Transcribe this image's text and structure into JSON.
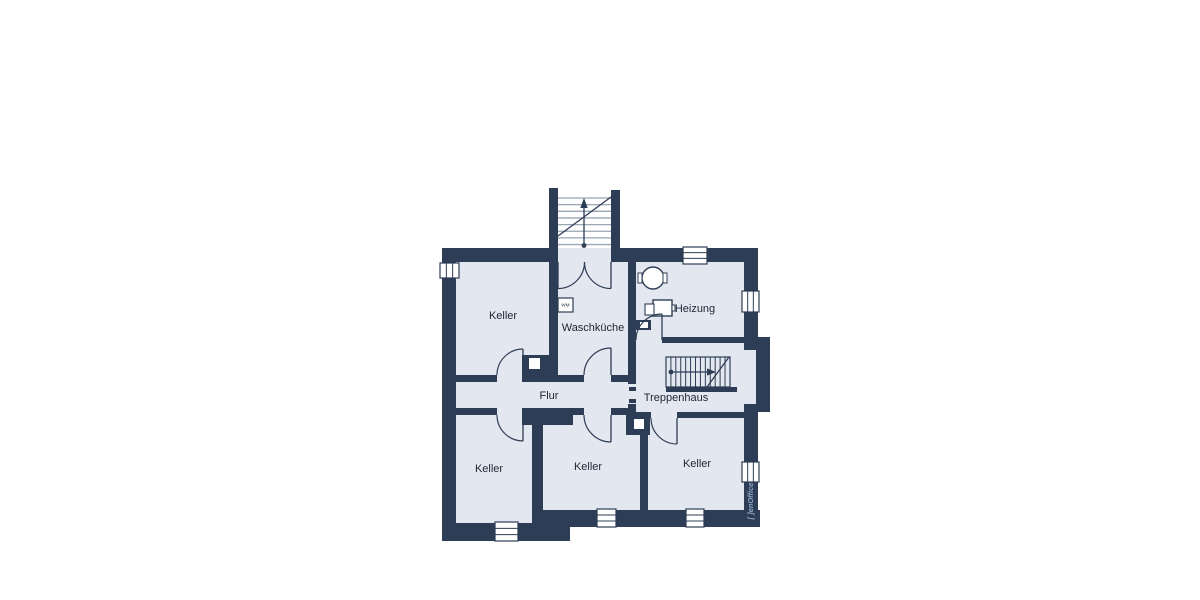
{
  "canvas": {
    "width": 1200,
    "height": 600
  },
  "colors": {
    "wall": "#2d3d55",
    "floor": "#e3e8f0",
    "white": "#ffffff",
    "tread": "#9aa5b5",
    "text": "#1c2636",
    "logo": "#8ca6c6"
  },
  "rooms": [
    {
      "id": "keller-upper-left",
      "label": "Keller"
    },
    {
      "id": "waschkueche",
      "label": "Waschküche"
    },
    {
      "id": "heizung",
      "label": "Heizung"
    },
    {
      "id": "flur",
      "label": "Flur"
    },
    {
      "id": "treppenhaus",
      "label": "Treppenhaus"
    },
    {
      "id": "keller-lower-left",
      "label": "Keller"
    },
    {
      "id": "keller-lower-middle",
      "label": "Keller"
    },
    {
      "id": "keller-lower-right",
      "label": "Keller"
    }
  ],
  "appliances": [
    {
      "id": "washing-machine",
      "label": "WM"
    }
  ],
  "branding": {
    "logo_text": "[ ]enOffice"
  },
  "floorplan": {
    "shapes": [
      {
        "type": "rect",
        "name": "floor-keller-upper-left",
        "x": 456,
        "y": 262,
        "w": 93,
        "h": 113,
        "fill": "floor"
      },
      {
        "type": "rect",
        "name": "floor-waschkueche",
        "x": 558,
        "y": 262,
        "w": 70,
        "h": 113,
        "fill": "floor"
      },
      {
        "type": "rect",
        "name": "floor-stair-landing",
        "x": 558,
        "y": 248,
        "w": 53,
        "h": 14,
        "fill": "floor"
      },
      {
        "type": "rect",
        "name": "floor-heizung",
        "x": 636,
        "y": 262,
        "w": 108,
        "h": 81,
        "fill": "floor"
      },
      {
        "type": "rect",
        "name": "floor-treppenhaus",
        "x": 636,
        "y": 343,
        "w": 108,
        "h": 69,
        "fill": "floor"
      },
      {
        "type": "rect",
        "name": "floor-flur",
        "x": 456,
        "y": 382,
        "w": 172,
        "h": 26,
        "fill": "floor"
      },
      {
        "type": "rect",
        "name": "floor-threshold",
        "x": 628,
        "y": 384,
        "w": 8,
        "h": 20,
        "fill": "floor"
      },
      {
        "type": "rect",
        "name": "floor-keller-lower-left",
        "x": 456,
        "y": 415,
        "w": 76,
        "h": 108,
        "fill": "floor"
      },
      {
        "type": "rect",
        "name": "floor-keller-lower-middle",
        "x": 543,
        "y": 415,
        "w": 97,
        "h": 95,
        "fill": "floor"
      },
      {
        "type": "rect",
        "name": "floor-keller-lower-right",
        "x": 648,
        "y": 418,
        "w": 96,
        "h": 92,
        "fill": "floor"
      },
      {
        "type": "rect",
        "name": "floor-door-opening",
        "x": 497,
        "y": 375,
        "w": 26,
        "h": 7,
        "fill": "floor"
      },
      {
        "type": "rect",
        "name": "floor-door-opening",
        "x": 584,
        "y": 375,
        "w": 27,
        "h": 7,
        "fill": "floor"
      },
      {
        "type": "rect",
        "name": "floor-door-opening",
        "x": 497,
        "y": 408,
        "w": 26,
        "h": 7,
        "fill": "floor"
      },
      {
        "type": "rect",
        "name": "floor-door-opening",
        "x": 584,
        "y": 408,
        "w": 27,
        "h": 7,
        "fill": "floor"
      },
      {
        "type": "rect",
        "name": "floor-door-opening",
        "x": 651,
        "y": 412,
        "w": 26,
        "h": 6,
        "fill": "floor"
      },
      {
        "type": "rect",
        "name": "wall-exterior-top-left",
        "x": 442,
        "y": 248,
        "w": 116,
        "h": 14,
        "fill": "wall"
      },
      {
        "type": "rect",
        "name": "wall-exterior-top-right",
        "x": 611,
        "y": 248,
        "w": 147,
        "h": 14,
        "fill": "wall"
      },
      {
        "type": "rect",
        "name": "wall-exterior-left",
        "x": 442,
        "y": 248,
        "w": 14,
        "h": 293,
        "fill": "wall"
      },
      {
        "type": "rect",
        "name": "wall-exterior-bottom-left",
        "x": 442,
        "y": 523,
        "w": 101,
        "h": 18,
        "fill": "wall"
      },
      {
        "type": "rect",
        "name": "wall-exterior-bottom-step",
        "x": 543,
        "y": 510,
        "w": 27,
        "h": 31,
        "fill": "wall"
      },
      {
        "type": "rect",
        "name": "wall-exterior-bottom-right",
        "x": 570,
        "y": 510,
        "w": 190,
        "h": 17,
        "fill": "wall"
      },
      {
        "type": "rect",
        "name": "wall-exterior-right",
        "x": 744,
        "y": 248,
        "w": 14,
        "h": 262,
        "fill": "wall"
      },
      {
        "type": "rect",
        "name": "wall-stairwell-bump",
        "x": 744,
        "y": 337,
        "w": 26,
        "h": 75,
        "fill": "wall"
      },
      {
        "type": "rect",
        "name": "wall-exterior-stair-left",
        "x": 549,
        "y": 188,
        "w": 9,
        "h": 194,
        "fill": "wall"
      },
      {
        "type": "rect",
        "name": "wall-exterior-stair-right",
        "x": 611,
        "y": 190,
        "w": 9,
        "h": 72,
        "fill": "wall"
      },
      {
        "type": "rect",
        "name": "wall-wasch-heizung",
        "x": 628,
        "y": 262,
        "w": 8,
        "h": 122,
        "fill": "wall"
      },
      {
        "type": "rect",
        "name": "wall-below-threshold",
        "x": 628,
        "y": 404,
        "w": 8,
        "h": 8,
        "fill": "wall"
      },
      {
        "type": "rect",
        "name": "wall-flur-top-a",
        "x": 456,
        "y": 375,
        "w": 41,
        "h": 7,
        "fill": "wall"
      },
      {
        "type": "rect",
        "name": "chimney-block",
        "x": 522,
        "y": 355,
        "w": 36,
        "h": 27,
        "fill": "wall"
      },
      {
        "type": "rect",
        "name": "wall-flur-top-b",
        "x": 555,
        "y": 375,
        "w": 29,
        "h": 7,
        "fill": "wall"
      },
      {
        "type": "rect",
        "name": "wall-flur-top-c",
        "x": 611,
        "y": 375,
        "w": 17,
        "h": 7,
        "fill": "wall"
      },
      {
        "type": "rect",
        "name": "wall-flur-bottom-a",
        "x": 456,
        "y": 408,
        "w": 41,
        "h": 7,
        "fill": "wall"
      },
      {
        "type": "rect",
        "name": "wall-flur-bottom-block",
        "x": 522,
        "y": 408,
        "w": 51,
        "h": 17,
        "fill": "wall"
      },
      {
        "type": "rect",
        "name": "wall-flur-bottom-b",
        "x": 573,
        "y": 408,
        "w": 11,
        "h": 7,
        "fill": "wall"
      },
      {
        "type": "rect",
        "name": "wall-flur-bottom-c",
        "x": 611,
        "y": 408,
        "w": 17,
        "h": 7,
        "fill": "wall"
      },
      {
        "type": "rect",
        "name": "wall-keller-divider-left",
        "x": 532,
        "y": 415,
        "w": 11,
        "h": 108,
        "fill": "wall"
      },
      {
        "type": "rect",
        "name": "wall-keller-divider-right",
        "x": 640,
        "y": 418,
        "w": 8,
        "h": 92,
        "fill": "wall"
      },
      {
        "type": "rect",
        "name": "wall-heizung-bottom",
        "x": 662,
        "y": 337,
        "w": 82,
        "h": 6,
        "fill": "wall"
      },
      {
        "type": "rect",
        "name": "wall-trepp-bottom-a",
        "x": 628,
        "y": 412,
        "w": 23,
        "h": 6,
        "fill": "wall"
      },
      {
        "type": "rect",
        "name": "wall-trepp-bottom-b",
        "x": 677,
        "y": 412,
        "w": 67,
        "h": 6,
        "fill": "wall"
      },
      {
        "type": "rect",
        "name": "chimney-block",
        "x": 626,
        "y": 412,
        "w": 24,
        "h": 23,
        "fill": "wall"
      },
      {
        "type": "rect",
        "name": "chimney-block",
        "x": 636,
        "y": 320,
        "w": 15,
        "h": 10,
        "fill": "wall"
      },
      {
        "type": "rect",
        "name": "stair-lower-edge-bar",
        "x": 666,
        "y": 387,
        "w": 71,
        "h": 5,
        "fill": "wall"
      },
      {
        "type": "rect",
        "name": "floor-stairwell-bump-inner",
        "x": 744,
        "y": 350,
        "w": 12,
        "h": 54,
        "fill": "floor"
      },
      {
        "type": "rect",
        "name": "chimney-flue",
        "x": 529,
        "y": 358,
        "w": 11,
        "h": 11,
        "fill": "white"
      },
      {
        "type": "rect",
        "name": "chimney-flue",
        "x": 634,
        "y": 419,
        "w": 10,
        "h": 10,
        "fill": "white"
      },
      {
        "type": "rect",
        "name": "chimney-flue",
        "x": 640,
        "y": 322,
        "w": 8,
        "h": 6,
        "fill": "white"
      },
      {
        "type": "window",
        "name": "window-left-wall",
        "x": 440,
        "y": 263,
        "w": 19,
        "h": 15,
        "orient": "v"
      },
      {
        "type": "window",
        "name": "window-top-wall",
        "x": 683,
        "y": 247,
        "w": 24,
        "h": 17,
        "orient": "h"
      },
      {
        "type": "window",
        "name": "window-right-heizung",
        "x": 742,
        "y": 291,
        "w": 17,
        "h": 21,
        "orient": "v"
      },
      {
        "type": "window",
        "name": "window-right-keller",
        "x": 742,
        "y": 462,
        "w": 17,
        "h": 20,
        "orient": "v"
      },
      {
        "type": "window",
        "name": "window-bottom-left",
        "x": 495,
        "y": 522,
        "w": 23,
        "h": 19,
        "orient": "h"
      },
      {
        "type": "window",
        "name": "window-bottom-middle",
        "x": 597,
        "y": 509,
        "w": 19,
        "h": 18,
        "orient": "h"
      },
      {
        "type": "window",
        "name": "window-bottom-right",
        "x": 686,
        "y": 509,
        "w": 18,
        "h": 18,
        "orient": "h"
      },
      {
        "type": "rect",
        "name": "threshold-dash",
        "x": 629,
        "y": 387,
        "w": 7,
        "h": 4,
        "fill": "wall"
      },
      {
        "type": "rect",
        "name": "threshold-dash",
        "x": 629,
        "y": 399,
        "w": 7,
        "h": 4,
        "fill": "wall"
      },
      {
        "type": "hlines",
        "name": "exterior-stair-treads",
        "x1": 558,
        "x2": 611,
        "y": 198,
        "step": 6.65,
        "n": 8,
        "color": "tread",
        "width": 1.3
      },
      {
        "type": "line",
        "name": "exterior-stair-stringer",
        "x1": 558,
        "y1": 236,
        "x2": 611,
        "y2": 197,
        "color": "wall",
        "width": 1.3
      },
      {
        "type": "line",
        "name": "exterior-stair-arrow-line",
        "x1": 584,
        "y1": 247,
        "x2": 584,
        "y2": 205,
        "color": "wall",
        "width": 1.3
      },
      {
        "type": "polygon",
        "name": "exterior-stair-arrow-head",
        "points": "584,198 580.3,208 587.7,208",
        "fill": "wall"
      },
      {
        "type": "circle",
        "name": "exterior-stair-arrow-dot",
        "cx": 584,
        "cy": 245.5,
        "r": 2.4,
        "fill": "wall"
      },
      {
        "type": "rect",
        "name": "interior-stair-frame",
        "x": 666,
        "y": 357,
        "w": 64,
        "h": 30,
        "fill": "none",
        "stroke": "wall",
        "sw": 1.2
      },
      {
        "type": "vlines",
        "name": "interior-stair-risers",
        "y1": 357,
        "y2": 387,
        "x": 670.9,
        "step": 4.92,
        "n": 12,
        "color": "wall",
        "width": 1
      },
      {
        "type": "line",
        "name": "interior-stair-stringer",
        "x1": 707,
        "y1": 387,
        "x2": 729,
        "y2": 357,
        "color": "wall",
        "width": 1.3
      },
      {
        "type": "line",
        "name": "interior-stair-arrow-line",
        "x1": 671,
        "y1": 372,
        "x2": 710,
        "y2": 372,
        "color": "wall",
        "width": 1.3
      },
      {
        "type": "polygon",
        "name": "interior-stair-arrow-head",
        "points": "716,372 707,368.4 707,375.6",
        "fill": "wall"
      },
      {
        "type": "circle",
        "name": "interior-stair-arrow-dot",
        "cx": 671,
        "cy": 372,
        "r": 2.4,
        "fill": "wall"
      },
      {
        "type": "circle",
        "name": "boiler-tank-circle",
        "cx": 653,
        "cy": 278,
        "r": 11,
        "fill": "white",
        "stroke": "wall",
        "sw": 1.4
      },
      {
        "type": "rect",
        "name": "boiler-nub",
        "x": 638,
        "y": 273,
        "w": 4,
        "h": 10,
        "fill": "white",
        "stroke": "wall",
        "sw": 1
      },
      {
        "type": "rect",
        "name": "boiler-nub",
        "x": 663,
        "y": 273,
        "w": 4,
        "h": 10,
        "fill": "white",
        "stroke": "wall",
        "sw": 1
      },
      {
        "type": "rect",
        "name": "heater-box",
        "x": 653,
        "y": 300,
        "w": 19,
        "h": 16,
        "fill": "white",
        "stroke": "wall",
        "sw": 1.4
      },
      {
        "type": "rect",
        "name": "heater-box-small",
        "x": 645,
        "y": 304,
        "w": 9,
        "h": 11,
        "fill": "white",
        "stroke": "wall",
        "sw": 1.1
      },
      {
        "type": "rect",
        "name": "heater-pipe",
        "x": 672,
        "y": 305,
        "w": 3,
        "h": 6,
        "fill": "white",
        "stroke": "wall",
        "sw": 1
      },
      {
        "type": "rect",
        "name": "washing-machine-box",
        "x": 558,
        "y": 298,
        "w": 15,
        "h": 14,
        "fill": "white",
        "stroke": "wall",
        "sw": 1.2
      },
      {
        "type": "path",
        "name": "door-leaf",
        "d": "M558,262 L558,288.5",
        "color": "wall",
        "width": 1.3
      },
      {
        "type": "path",
        "name": "door-arc",
        "d": "M584.5,262 A26.5,26.5 0 0 1 558,288.5",
        "color": "wall",
        "width": 1.2
      },
      {
        "type": "path",
        "name": "door-leaf",
        "d": "M611,262 L611,288.5",
        "color": "wall",
        "width": 1.3
      },
      {
        "type": "path",
        "name": "door-arc",
        "d": "M584.5,262 A26.5,26.5 0 0 0 611,288.5",
        "color": "wall",
        "width": 1.2
      },
      {
        "type": "path",
        "name": "door-leaf",
        "d": "M523,375 L523,349",
        "color": "wall",
        "width": 1.3
      },
      {
        "type": "path",
        "name": "door-arc",
        "d": "M497,375 A26,26 0 0 1 523,349",
        "color": "wall",
        "width": 1.2
      },
      {
        "type": "path",
        "name": "door-leaf",
        "d": "M611,375 L611,348",
        "color": "wall",
        "width": 1.3
      },
      {
        "type": "path",
        "name": "door-arc",
        "d": "M584,375 A27,27 0 0 1 611,348",
        "color": "wall",
        "width": 1.2
      },
      {
        "type": "path",
        "name": "door-leaf",
        "d": "M523,415 L523,441",
        "color": "wall",
        "width": 1.3
      },
      {
        "type": "path",
        "name": "door-arc",
        "d": "M497,415 A26,26 0 0 0 523,441",
        "color": "wall",
        "width": 1.2
      },
      {
        "type": "path",
        "name": "door-leaf",
        "d": "M611,415 L611,442",
        "color": "wall",
        "width": 1.3
      },
      {
        "type": "path",
        "name": "door-arc",
        "d": "M584,415 A27,27 0 0 0 611,442",
        "color": "wall",
        "width": 1.2
      },
      {
        "type": "path",
        "name": "door-leaf",
        "d": "M677,418 L677,444",
        "color": "wall",
        "width": 1.3
      },
      {
        "type": "path",
        "name": "door-arc",
        "d": "M651,418 A26,26 0 0 0 677,444",
        "color": "wall",
        "width": 1.2
      },
      {
        "type": "path",
        "name": "door-leaf",
        "d": "M662,340 L662,314",
        "color": "wall",
        "width": 1.3
      },
      {
        "type": "path",
        "name": "door-arc",
        "d": "M662,314 A26,26 0 0 0 636,340",
        "color": "wall",
        "width": 1.2
      },
      {
        "type": "text",
        "name": "room-label-keller-upper-left",
        "bind": "rooms.0.label",
        "x": 503,
        "y": 319,
        "size": 11,
        "color": "text"
      },
      {
        "type": "text",
        "name": "room-label-waschkueche",
        "bind": "rooms.1.label",
        "x": 593,
        "y": 331,
        "size": 11,
        "color": "text"
      },
      {
        "type": "text",
        "name": "room-label-heizung",
        "bind": "rooms.2.label",
        "x": 695,
        "y": 312,
        "size": 11,
        "color": "text"
      },
      {
        "type": "text",
        "name": "room-label-flur",
        "bind": "rooms.3.label",
        "x": 549,
        "y": 399,
        "size": 11,
        "color": "text"
      },
      {
        "type": "text",
        "name": "room-label-treppenhaus",
        "bind": "rooms.4.label",
        "x": 676,
        "y": 401,
        "size": 11,
        "color": "text"
      },
      {
        "type": "text",
        "name": "room-label-keller-lower-left",
        "bind": "rooms.5.label",
        "x": 489,
        "y": 472,
        "size": 11,
        "color": "text"
      },
      {
        "type": "text",
        "name": "room-label-keller-lower-middle",
        "bind": "rooms.6.label",
        "x": 588,
        "y": 470,
        "size": 11,
        "color": "text"
      },
      {
        "type": "text",
        "name": "room-label-keller-lower-right",
        "bind": "rooms.7.label",
        "x": 697,
        "y": 467,
        "size": 11,
        "color": "text"
      },
      {
        "type": "text",
        "name": "washing-machine-label",
        "bind": "appliances.0.label",
        "x": 565.5,
        "y": 306.5,
        "size": 4.6,
        "color": "text"
      },
      {
        "type": "text",
        "name": "logo-text",
        "bind": "branding.logo_text",
        "x": 753,
        "y": 501,
        "size": 7.5,
        "color": "logo",
        "rotate": -90,
        "italic": true,
        "bold": true
      }
    ]
  }
}
